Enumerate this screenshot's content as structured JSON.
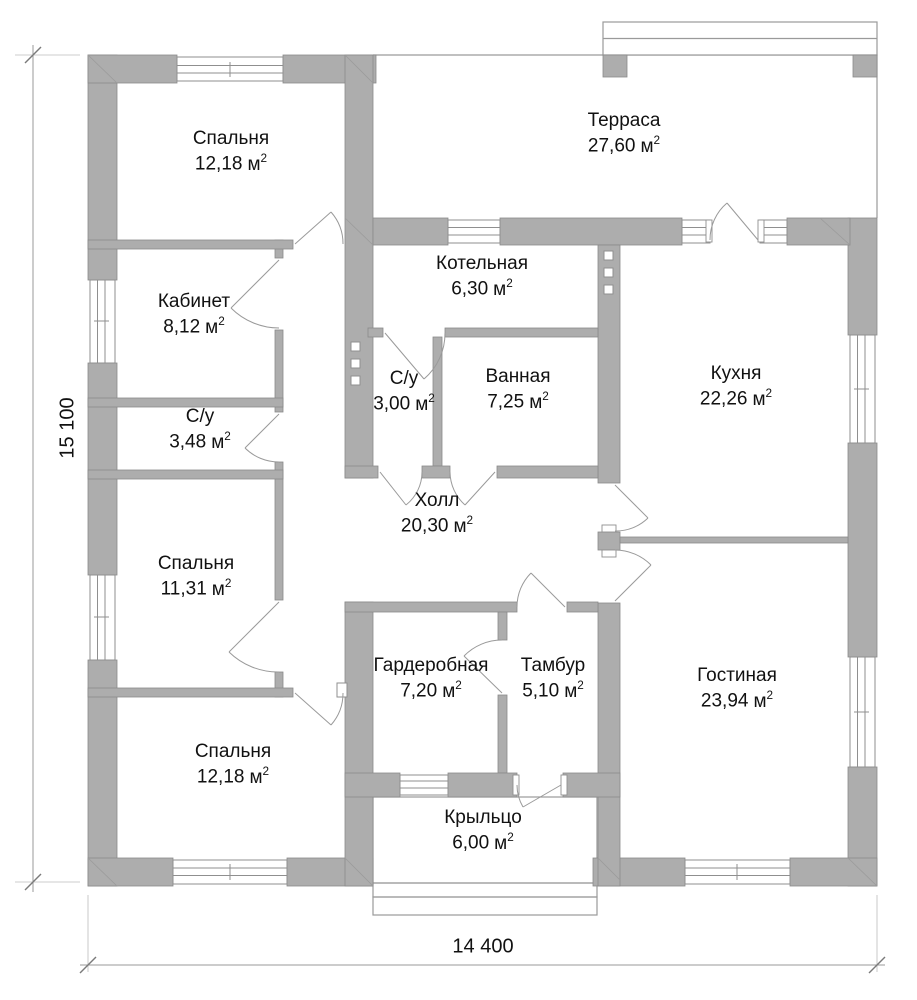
{
  "plan": {
    "units": {
      "base": "м",
      "exp": "2"
    },
    "rooms": [
      {
        "id": "bedroom-top-left",
        "name": "Спальня",
        "area": "12,18"
      },
      {
        "id": "terrace",
        "name": "Терраса",
        "area": "27,60"
      },
      {
        "id": "study",
        "name": "Кабинет",
        "area": "8,12"
      },
      {
        "id": "boiler-room",
        "name": "Котельная",
        "area": "6,30"
      },
      {
        "id": "wc-small",
        "name": "С/у",
        "area": "3,00"
      },
      {
        "id": "bathroom",
        "name": "Ванная",
        "area": "7,25"
      },
      {
        "id": "kitchen",
        "name": "Кухня",
        "area": "22,26"
      },
      {
        "id": "wc-left",
        "name": "С/у",
        "area": "3,48"
      },
      {
        "id": "hall",
        "name": "Холл",
        "area": "20,30"
      },
      {
        "id": "bedroom-mid-left",
        "name": "Спальня",
        "area": "11,31"
      },
      {
        "id": "wardrobe",
        "name": "Гардеробная",
        "area": "7,20"
      },
      {
        "id": "vestibule",
        "name": "Тамбур",
        "area": "5,10"
      },
      {
        "id": "living-room",
        "name": "Гостиная",
        "area": "23,94"
      },
      {
        "id": "bedroom-bot-left",
        "name": "Спальня",
        "area": "12,18"
      },
      {
        "id": "porch",
        "name": "Крыльцо",
        "area": "6,00"
      }
    ],
    "dimensions": {
      "height_label": "15 100",
      "width_label": "14 400"
    },
    "colors": {
      "wall_fill": "#ADADAD",
      "wall_stroke": "#8A8A8A",
      "thin_line": "#9A9A9A"
    }
  }
}
